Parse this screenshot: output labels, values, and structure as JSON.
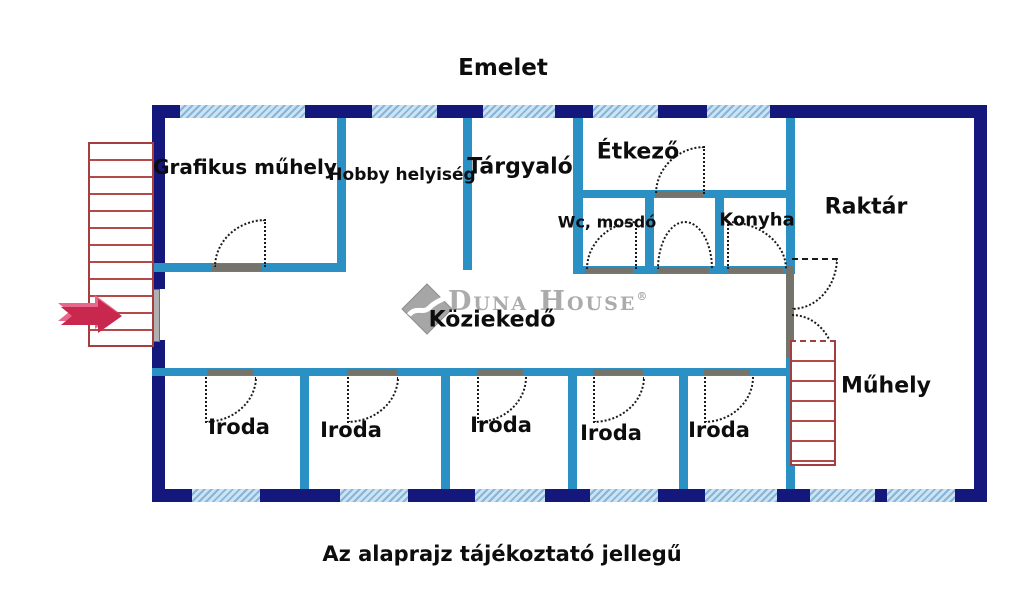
{
  "page": {
    "title": "Emelet",
    "footer_note": "Az alaprajz tájékoztató jellegű"
  },
  "watermark": {
    "brand": "Duna House",
    "registered": "®"
  },
  "rooms": {
    "grafikus_muhely": "Grafikus műhely",
    "hobby_helyiseg": "Hobby helyiség",
    "targyalo": "Tárgyaló",
    "etkezo": "Étkező",
    "wc_mosdo": "Wc, mosdó",
    "konyha": "Konyha",
    "raktar": "Raktár",
    "kozlekedo": "Köziekedő",
    "muhely": "Műhely",
    "iroda": "Iroda"
  },
  "colors": {
    "outer_wall": "#14177c",
    "inner_wall": "#2b91c4",
    "window_fill": "#cde2f2",
    "window_stripe": "#85b6d8",
    "stairs": "#a53e3e",
    "entry_arrow": "#c8274e",
    "door_threshold": "#74746d",
    "watermark_gray": "#ababab",
    "text": "#0d0d0d"
  }
}
